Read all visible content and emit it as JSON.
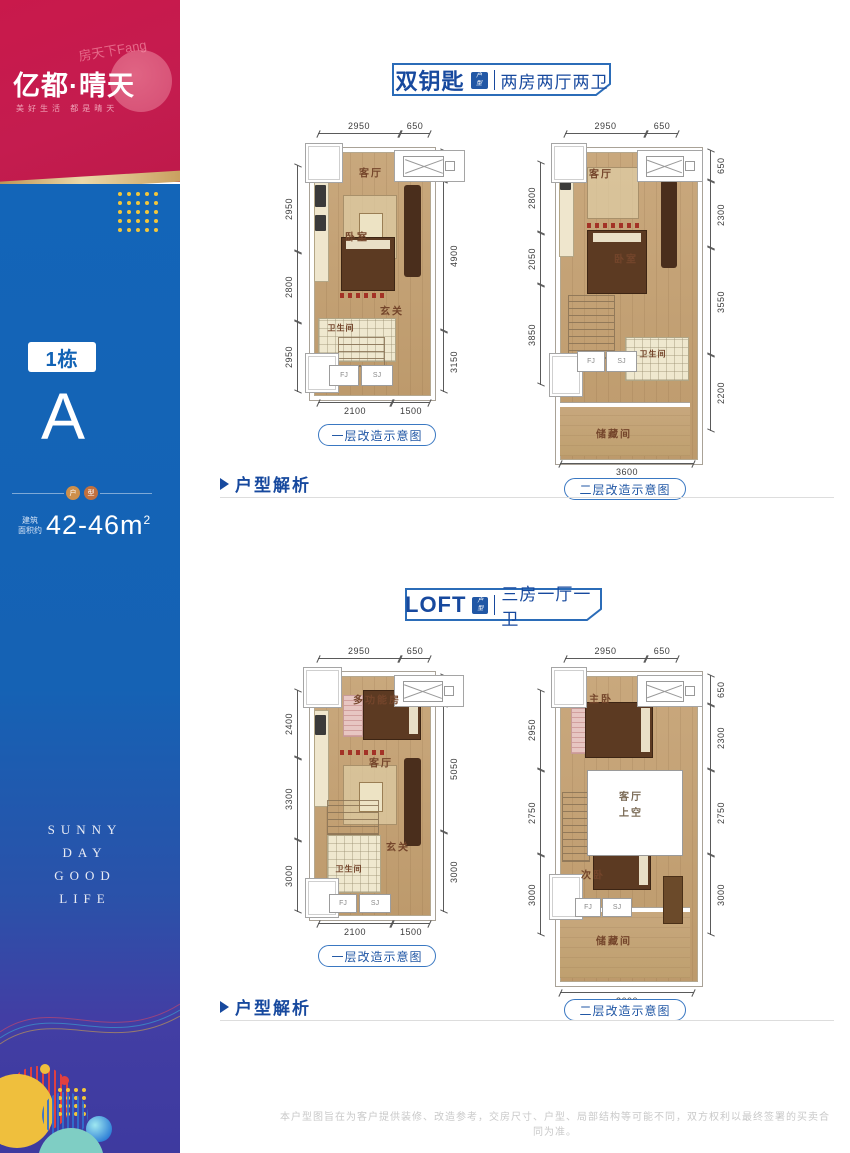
{
  "sidebar": {
    "watermark": "房天下Fang",
    "logo_title": "亿都·晴天",
    "logo_tagline": "美好生活 都是晴天",
    "building_badge": "1栋",
    "unit_letter": "A",
    "divider_char1": "户",
    "divider_char2": "型",
    "area_label_line1": "建筑",
    "area_label_line2": "面积约",
    "area_value": "42-46m",
    "area_sup": "2",
    "slogan_line1": "SUNNY",
    "slogan_line2": "DAY",
    "slogan_line3": "GOOD",
    "slogan_line4": "LIFE"
  },
  "colors": {
    "brand_red": "#C41C4F",
    "brand_blue": "#1365B8",
    "deep_indigo": "#3E3A9F",
    "accent_blue": "#17499E",
    "gold": "#C9A063"
  },
  "section1": {
    "header_title": "双钥匙",
    "header_badge_top": "户",
    "header_badge_bottom": "型",
    "header_subtitle": "两房两厅两卫",
    "analysis_label": "户型解析",
    "plan1": {
      "caption": "一层改造示意图",
      "dims_top": [
        "2950",
        "650"
      ],
      "dims_left": [
        "2950",
        "2800",
        "2950"
      ],
      "dims_right": [
        "650",
        "4900",
        "3150"
      ],
      "dims_bottom": [
        "2100",
        "1500"
      ],
      "room_living": "客厅",
      "room_bed": "卧室",
      "room_entry": "玄关",
      "room_bath": "卫生间",
      "box_fj": "FJ",
      "box_sj": "SJ"
    },
    "plan2": {
      "caption": "二层改造示意图",
      "dims_top": [
        "2950",
        "650"
      ],
      "dims_left": [
        "2800",
        "2050",
        "3850"
      ],
      "dims_right": [
        "650",
        "2300",
        "3550",
        "2200"
      ],
      "dims_bottom": [
        "3600"
      ],
      "room_living": "客厅",
      "room_bed": "卧室",
      "room_bath": "卫生间",
      "room_storage": "储藏间",
      "box_fj": "FJ",
      "box_sj": "SJ"
    }
  },
  "section2": {
    "header_title": "LOFT",
    "header_badge_top": "户",
    "header_badge_bottom": "型",
    "header_subtitle": "三房一厅一卫",
    "analysis_label": "户型解析",
    "plan1": {
      "caption": "一层改造示意图",
      "dims_top": [
        "2950",
        "650"
      ],
      "dims_left": [
        "2400",
        "3300",
        "3000"
      ],
      "dims_right": [
        "650",
        "5050",
        "3000"
      ],
      "dims_bottom": [
        "2100",
        "1500"
      ],
      "room_multi": "多功能房",
      "room_living": "客厅",
      "room_entry": "玄关",
      "room_bath": "卫生间",
      "box_fj": "FJ",
      "box_sj": "SJ"
    },
    "plan2": {
      "caption": "二层改造示意图",
      "dims_top": [
        "2950",
        "650"
      ],
      "dims_left": [
        "2950",
        "2750",
        "3000"
      ],
      "dims_right": [
        "650",
        "2300",
        "2750",
        "3000"
      ],
      "dims_bottom": [
        "3600"
      ],
      "room_master": "主卧",
      "room_void_line1": "客厅",
      "room_void_line2": "上空",
      "room_second": "次卧",
      "room_storage": "储藏间",
      "box_fj": "FJ",
      "box_sj": "SJ"
    }
  },
  "disclaimer": "本户型图旨在为客户提供装修、改造参考，交房尺寸、户型、局部结构等可能不同，双方权利以最终签署的买卖合同为准。"
}
